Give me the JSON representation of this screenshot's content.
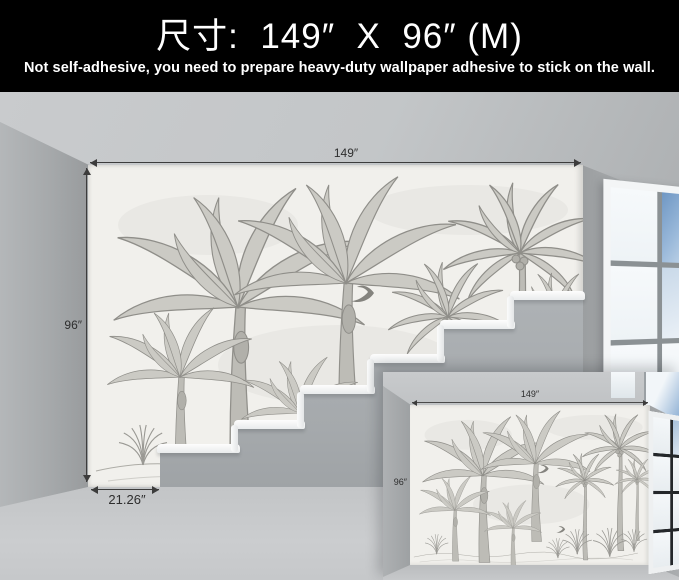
{
  "header": {
    "title": "尺寸:  149″  X  96″ (M)",
    "subtitle": "Not self-adhesive, you need to prepare heavy-duty wallpaper adhesive to stick on the wall."
  },
  "main_scene": {
    "width_label": "149″",
    "height_label": "96″",
    "bottom_strip_label": "21.26″"
  },
  "inset_scene": {
    "width_label": "149″",
    "height_label": "96″"
  },
  "colors": {
    "header_bg": "#000000",
    "header_text": "#ffffff",
    "wall_gray": "#a9acae",
    "ceiling_gray": "#c6c8ca",
    "floor_gray": "#c9cbcd",
    "wallpaper_base": "#f1f0ec",
    "mural_ink": "#8f8e89",
    "stair_tread_white": "#f6f7f8",
    "window_sky_blue": "#6f97c4",
    "dimension_line": "#3c3c3c"
  }
}
